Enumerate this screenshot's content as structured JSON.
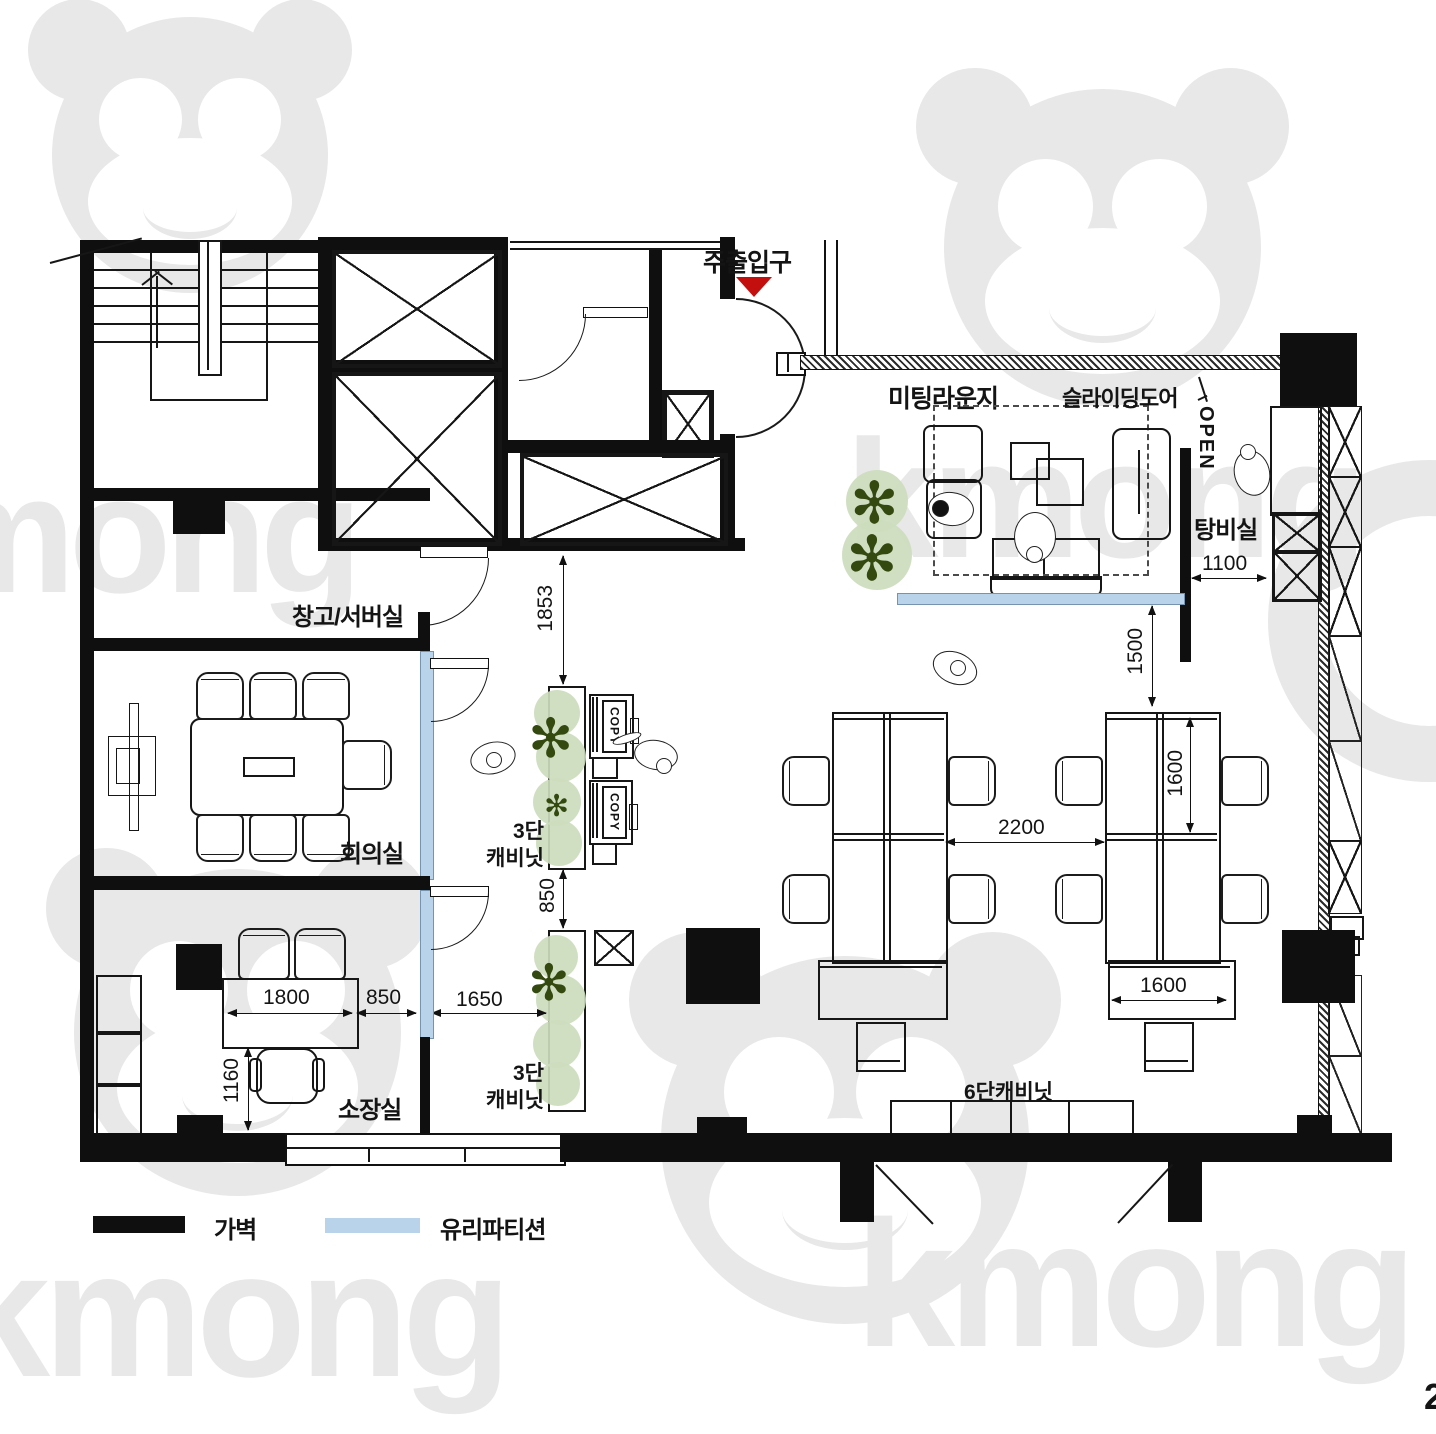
{
  "watermark": {
    "brand": "kmong"
  },
  "page": {
    "number": "2"
  },
  "legend": {
    "wall": "가벽",
    "glass": "유리파티션"
  },
  "rooms": {
    "entrance": "주출입구",
    "meeting_lounge": "미팅라운지",
    "sliding_door": "슬라이딩도어",
    "sliding_door_open": "OPEN",
    "pantry": "탕비실",
    "storage_server": "창고/서버실",
    "meeting_room": "회의실",
    "director_office": "소장실"
  },
  "furniture": {
    "cabinet3_line1": "3단",
    "cabinet3_line2": "캐비닛",
    "cabinet6": "6단캐비닛",
    "copier": "COPY"
  },
  "dimensions": {
    "entry_corridor": "1853",
    "cabinet_gap": "850",
    "corridor_width": "1650",
    "pantry_clearance": "1100",
    "lounge_clearance": "1500",
    "desk_row_gap": "2200",
    "desk_length": "1600",
    "desk_cabinet_width": "1600",
    "director_desk_width": "1800",
    "director_side_gap": "850",
    "director_desk_depth": "1160"
  },
  "colors": {
    "wall": "#111111",
    "glass_partition": "#b9d3ea",
    "plant_fill": "#ccdcbd",
    "plant_dark": "#33490f",
    "entrance_marker": "#c40f0f",
    "watermark": "#e8e8e8"
  }
}
